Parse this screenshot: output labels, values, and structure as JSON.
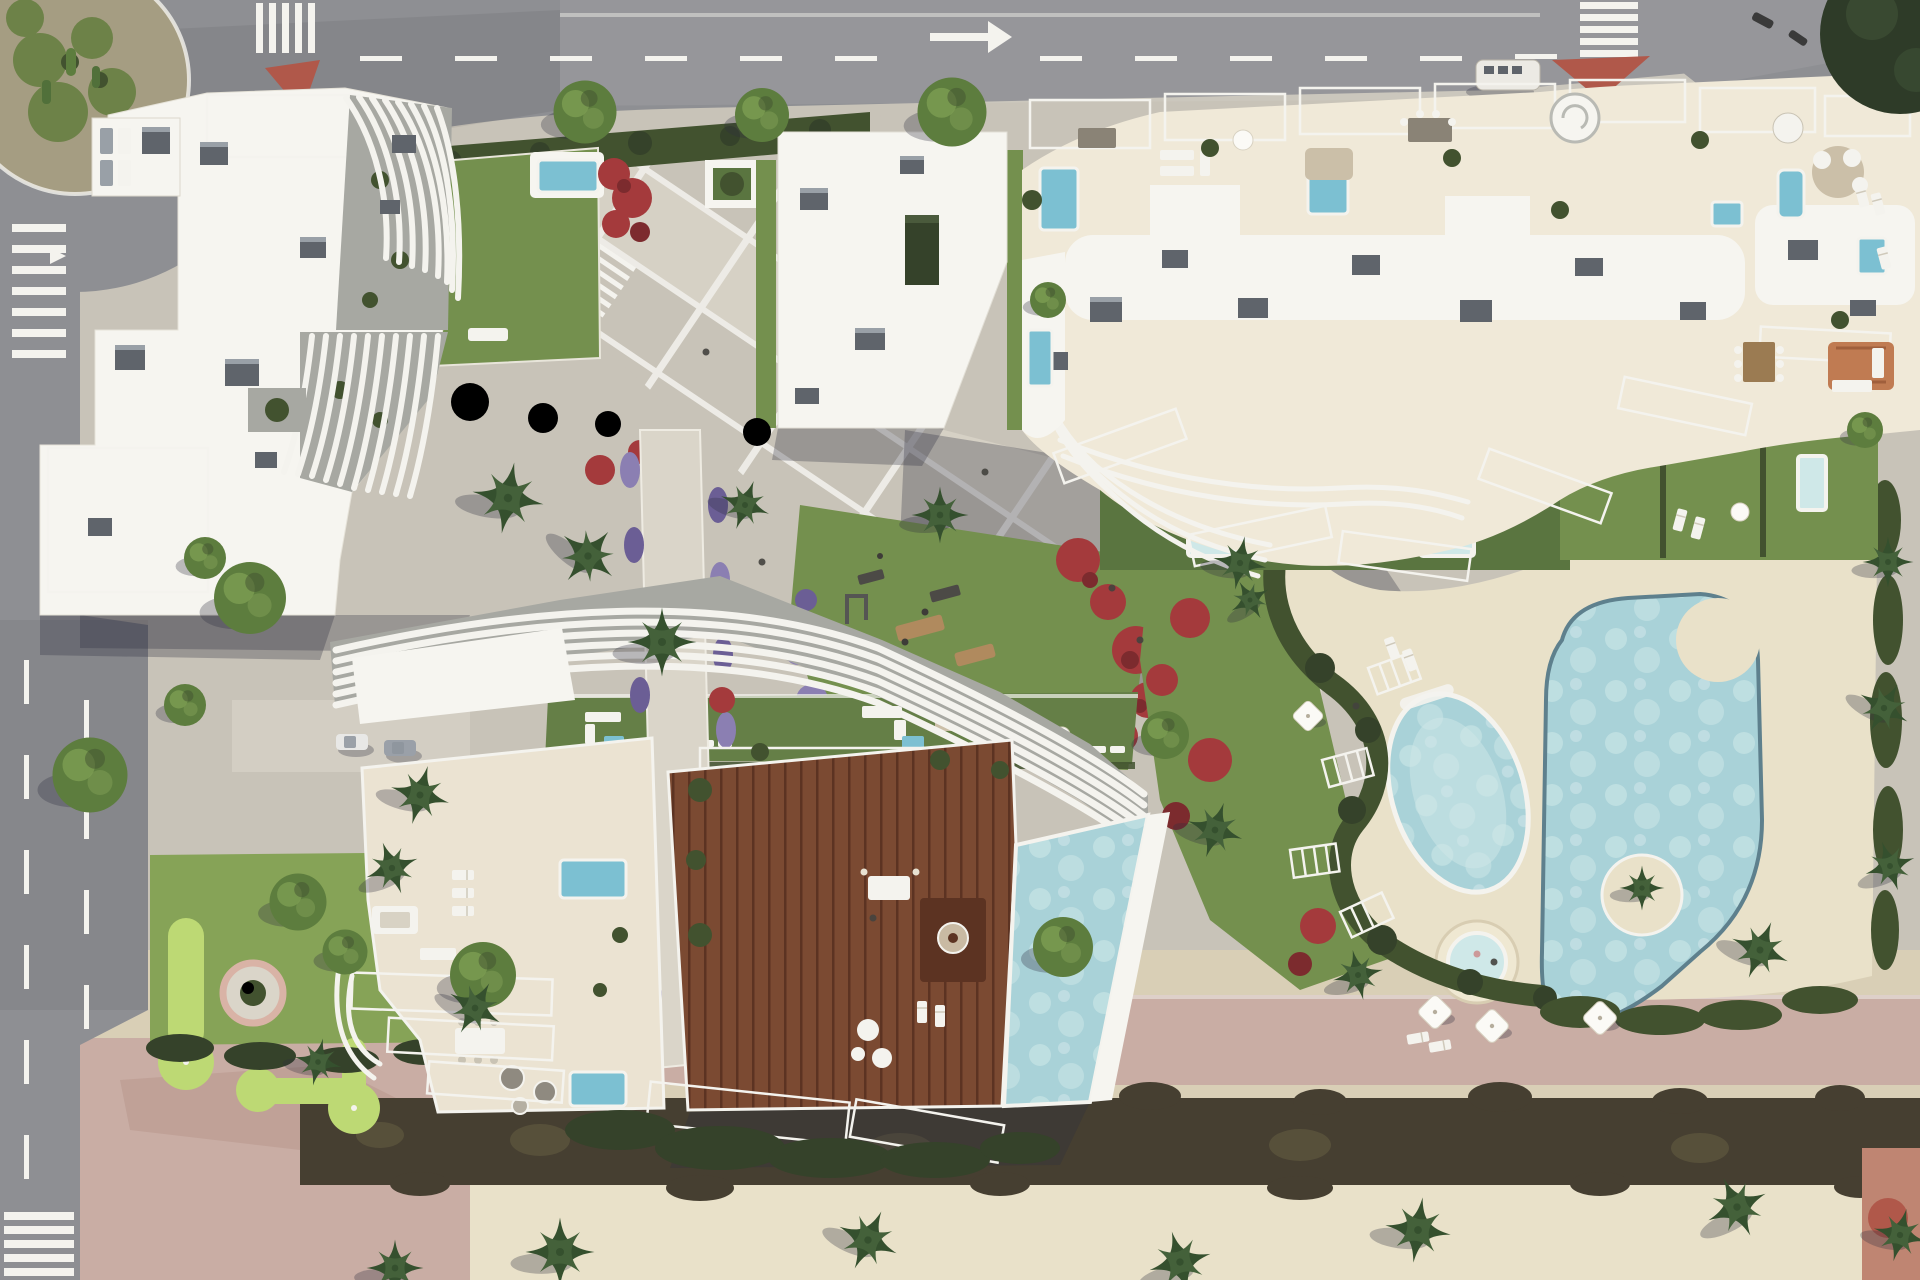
{
  "scene": {
    "type": "aerial-architectural-render",
    "description": "Top-down 3D render of a residential complex: three white sculptural apartment buildings with wavy slatted roofs, rooftop terraces with plunge pools, a wooden deck with lap pool, communal lagoon pools with jacuzzi, lawns with outdoor gym and mini-golf, paved plaza with diagonal white banding, perimeter roads with roundabout, crosswalks and a beach promenade at the bottom",
    "visible_text": ""
  },
  "palette": {
    "road": "#8e8f93",
    "roadShade": "#717277",
    "marking": "#f4f3ee",
    "pave": "#c8c3b8",
    "paveLight": "#dad5c9",
    "white": "#f6f5f0",
    "cream": "#ebe3d2",
    "creamSun": "#f0e9d8",
    "slatBg": "#a7a8a2",
    "lawn": "#74904e",
    "lawnDark": "#5a7540",
    "lawnTerrace": "#657f47",
    "hedge": "#42522f",
    "hedgeDark": "#35422a",
    "tree": "#5d7d3e",
    "treeLight": "#7d9d53",
    "palm": "#44613a",
    "palmDark": "#35502e",
    "flowerRed": "#a43a3c",
    "flowerRedDark": "#7c2b2e",
    "flowerPurple": "#8b7fb2",
    "flowerPurpleDark": "#6b5e95",
    "golfGreen": "#bdd974",
    "golfLawn": "#86a357",
    "poolWater": "#a9d2d8",
    "poolLight": "#cfe8e8",
    "poolDeep": "#7cc0d2",
    "poolRim": "#5e808d",
    "woodDeck": "#7b4a32",
    "woodDeckDark": "#5c3322",
    "grayBox": "#5f646b",
    "grayBoxLight": "#99a0a7",
    "sand": "#d9cfb6",
    "sandLight": "#e9e1c9",
    "pinkPaving": "#c9ada4",
    "pinkPavingDark": "#ba998f",
    "hedgeBand": "#463f31",
    "salmon": "#bf8572",
    "brickIsland": "#b0584a",
    "shadow": "rgba(47,47,62,0.30)",
    "islandGround": "#a59d82",
    "cactus": "#6d8248",
    "rug": "#c07b52",
    "tableBrown": "#9b7b52",
    "cornerTree": "#2e3b28"
  },
  "inventory": {
    "buildings": [
      "west-residential-building",
      "north-residential-building",
      "south-residential-building",
      "podium-roof-block"
    ],
    "water_features": [
      "lagoon-pool-main",
      "lagoon-pool-oval",
      "round-jacuzzi",
      "rooftop-lap-pool",
      "private-plunge-pools"
    ],
    "landscape": [
      "lawns",
      "hedges",
      "palm-trees",
      "round-trees",
      "red-flower-beds",
      "purple-flower-beds",
      "mini-golf-greens",
      "outdoor-gym-lawn"
    ],
    "infrastructure": [
      "top-road",
      "left-road",
      "roundabout",
      "crosswalks",
      "lane-markings",
      "right-turn-arrow",
      "traffic-islands",
      "plaza-with-white-banding",
      "beach-promenade"
    ],
    "vehicles": [
      "white-van",
      "parked-cars"
    ]
  }
}
